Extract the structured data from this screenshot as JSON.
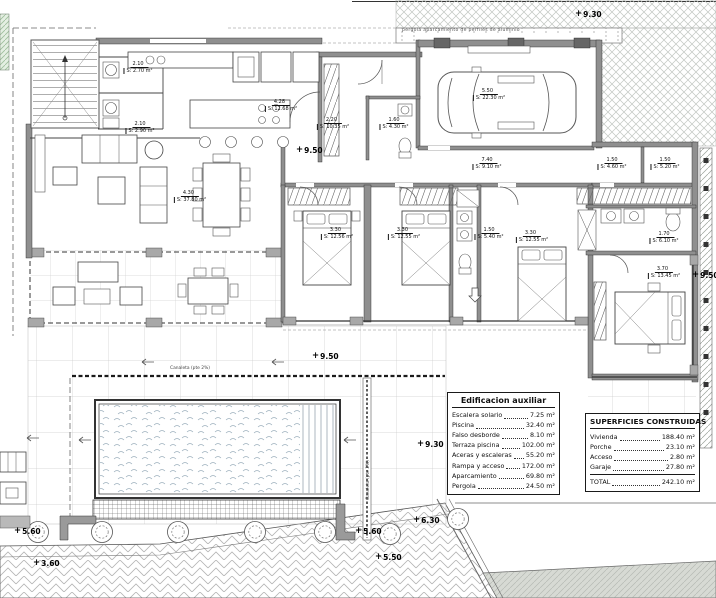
{
  "site": {
    "pergola_note": "pergola aparcamiento de perfiles de aluminio",
    "canaleta_h": "Canaleta (pte 2%)",
    "canaleta_v": "Canaleta (pte 2%)"
  },
  "room_labels": [
    {
      "dim": "2.10",
      "area": "S: 2.70 m²"
    },
    {
      "dim": "2.10",
      "area": "S: 2.90 m²"
    },
    {
      "dim": "4.28",
      "area": "S: 12.68 m²"
    },
    {
      "dim": "4.30",
      "area": "S: 37.80 m²"
    },
    {
      "dim": "2.20",
      "area": "S: 10.35 m²"
    },
    {
      "dim": "1.60",
      "area": "S: 4.30 m²"
    },
    {
      "dim": "5.50",
      "area": "S: 22.30 m²"
    },
    {
      "dim": "7.40",
      "area": "S: 9.10 m²"
    },
    {
      "dim": "1.50",
      "area": "S: 4.60 m²"
    },
    {
      "dim": "1.50",
      "area": "S: 5.20 m²"
    },
    {
      "dim": "3.30",
      "area": "S: 12.56 m²"
    },
    {
      "dim": "3.30",
      "area": "S: 12.55 m²"
    },
    {
      "dim": "1.50",
      "area": "S: 5.40 m²"
    },
    {
      "dim": "3.30",
      "area": "S: 12.55 m²"
    },
    {
      "dim": "1.70",
      "area": "S: 6.10 m²"
    },
    {
      "dim": "3.70",
      "area": "S: 13.45 m²"
    }
  ],
  "dims": [
    "9.30",
    "9.50",
    "9.50",
    "9.50",
    "9.30",
    "6.30",
    "5.60",
    "5.60",
    "5.50",
    "3.60",
    "7.10"
  ],
  "tables": {
    "aux": {
      "title": "Edificacion auxiliar",
      "rows": [
        {
          "label": "Escalera solario",
          "value": "7.25 m²"
        },
        {
          "label": "Piscina",
          "value": "32.40 m²"
        },
        {
          "label": "Falso desborde",
          "value": "8.10 m²"
        },
        {
          "label": "Terraza piscina",
          "value": "102.00 m²"
        },
        {
          "label": "Aceras y escaleras",
          "value": "55.20 m²"
        },
        {
          "label": "Rampa y acceso",
          "value": "172.00 m²"
        },
        {
          "label": "Aparcamiento",
          "value": "69.80 m²"
        },
        {
          "label": "Pergola",
          "value": "24.50 m²"
        }
      ]
    },
    "built": {
      "title": "SUPERFICIES CONSTRUIDAS",
      "rows": [
        {
          "label": "Vivienda",
          "value": "188.40 m²"
        },
        {
          "label": "Porche",
          "value": "23.10 m²"
        },
        {
          "label": "Acceso",
          "value": "2.80 m²"
        },
        {
          "label": "Garaje",
          "value": "27.80 m²"
        }
      ],
      "total_label": "TOTAL",
      "total_value": "242.10 m²"
    }
  }
}
